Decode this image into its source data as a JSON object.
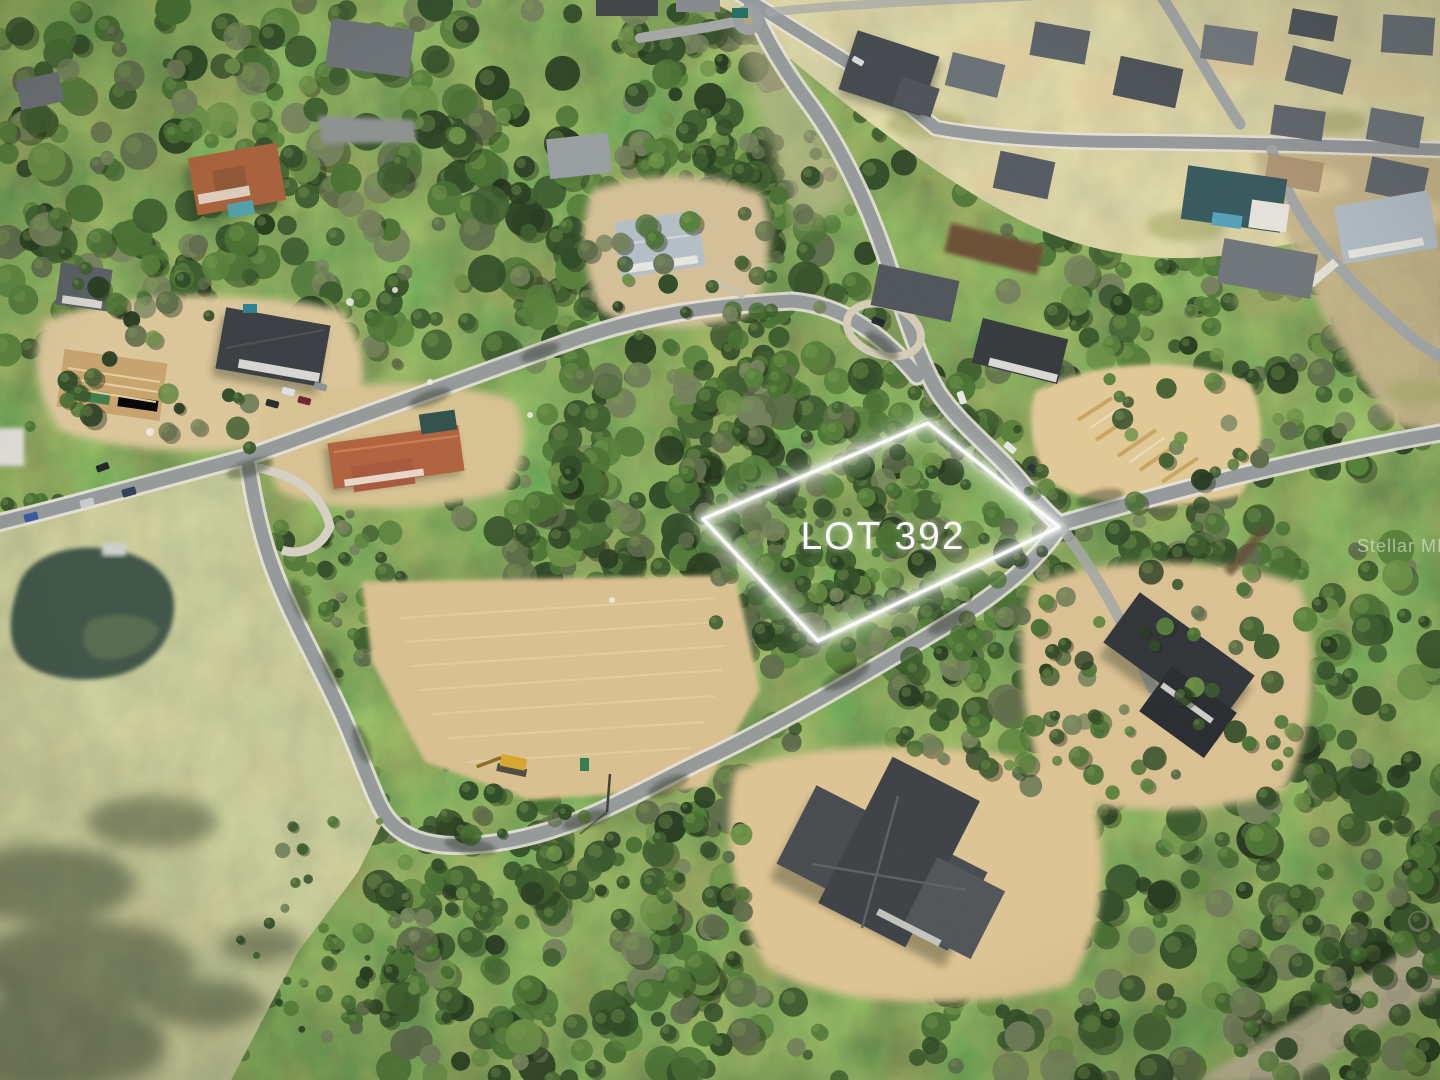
{
  "scene": {
    "type": "aerial-drone-photograph",
    "description": "Aerial view of a wooded residential development with a vacant tree-covered lot outlined in white",
    "lot": {
      "label": "LOT 392",
      "outline_color": "#ffffff"
    },
    "watermark": {
      "text": "Stellar MLS",
      "color": "#ffffff"
    },
    "palette": {
      "canopy_dark": "#2c4722",
      "canopy_mid": "#41612c",
      "canopy_light": "#5e8038",
      "field_olive": "#999c64",
      "sand": "#dcc392",
      "road_asphalt": "#95999a",
      "sidewalk": "#e8e4da",
      "pond_water": "#3c5344",
      "terracotta_roof": "#b2603c",
      "charcoal_roof": "#3a3e42",
      "slate_roof": "#6e7478",
      "pale_blue_roof": "#b6c1c8",
      "teal_roof": "#355d60",
      "excavator_yellow": "#d9a72c"
    }
  }
}
